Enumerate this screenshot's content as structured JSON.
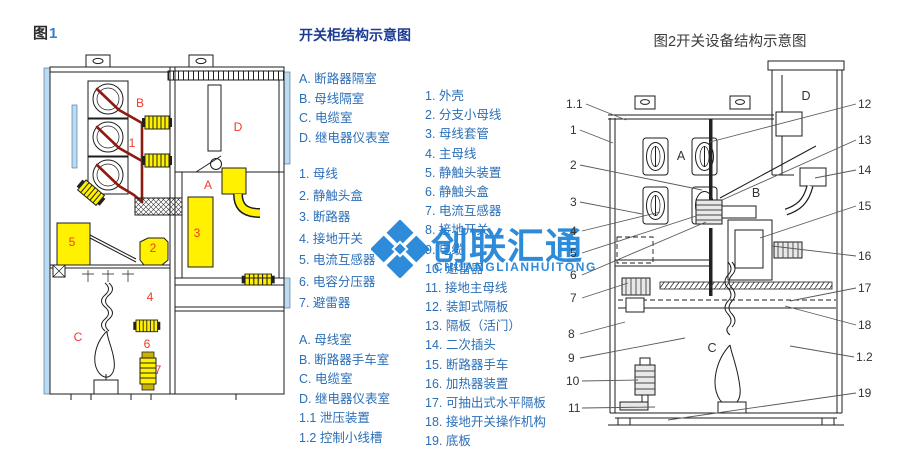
{
  "colors": {
    "legend_blue": "#2b6fb7",
    "title_navy": "#1c3c94",
    "fig_label_red": "#f0382b",
    "highlight_yellow": "#fff100",
    "busbar_dark_red": "#8e1a10",
    "panel_light_blue": "#badbf2",
    "watermark_blue": "#1c82d6"
  },
  "fig1": {
    "label_prefix": "图",
    "label_number": "1",
    "zone_labels": [
      "B",
      "D",
      "1",
      "A",
      "5",
      "2",
      "3",
      "4",
      "C",
      "6",
      "7"
    ]
  },
  "legend_left": {
    "title": "开关柜结构示意图",
    "group1": [
      "A. 断路器隔室",
      "B. 母线隔室",
      "C. 电缆室",
      "D. 继电器仪表室"
    ],
    "group2": [
      "1. 母线",
      "2. 静触头盒",
      "3. 断路器",
      "4. 接地开关",
      "5. 电流互感器",
      "6. 电容分压器",
      "7. 避雷器"
    ],
    "group3": [
      "A. 母线室",
      "B. 断路器手车室",
      "C. 电缆室",
      "D. 继电器仪表室",
      "1.1 泄压装置",
      "1.2 控制小线槽"
    ]
  },
  "legend_right": {
    "items": [
      "1. 外壳",
      "2. 分支小母线",
      "3. 母线套管",
      "4. 主母线",
      "5. 静触头装置",
      "6. 静触头盒",
      "7. 电流互感器",
      "8. 接地开关",
      "9. 电缆",
      "10. 避雷器",
      "11. 接地主母线",
      "12. 装卸式隔板",
      "13. 隔板（活门）",
      "14. 二次插头",
      "15. 断路器手车",
      "16. 加热器装置",
      "17. 可抽出式水平隔板",
      "18. 接地开关操作机构",
      "19. 底板"
    ]
  },
  "fig2": {
    "title": "图2开关设备结构示意图",
    "left_callouts": [
      "1.1",
      "1",
      "2",
      "3",
      "4",
      "5",
      "6",
      "7",
      "8",
      "9",
      "10",
      "11"
    ],
    "right_callouts": [
      "12",
      "13",
      "14",
      "15",
      "16",
      "17",
      "18",
      "1.2",
      "19"
    ],
    "zone_labels": [
      "A",
      "B",
      "C",
      "D"
    ]
  },
  "watermark": {
    "text": "创联汇通",
    "subtext": "CHUANGLIANHUITONG"
  }
}
